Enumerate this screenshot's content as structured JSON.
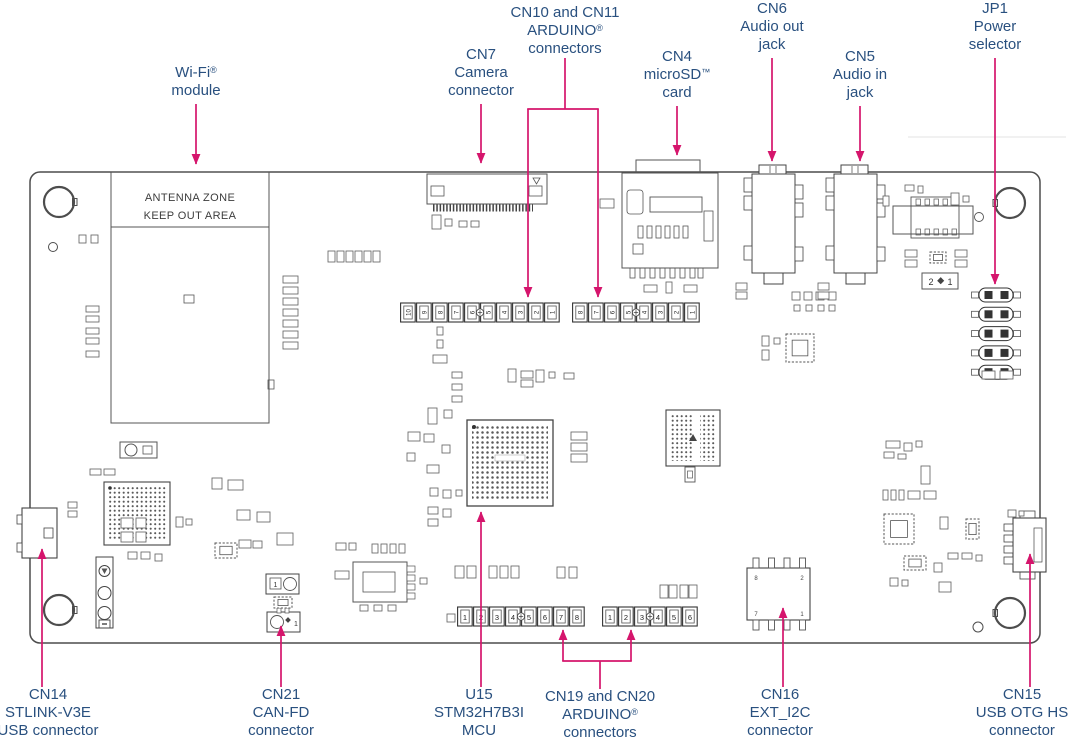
{
  "figure": {
    "type": "pcb-connector-diagram",
    "colors": {
      "label_text": "#29507f",
      "arrow": "#d5156c",
      "board_line": "#4d4d4d"
    },
    "board": {
      "antenna_zone_line1": "ANTENNA ZONE",
      "antenna_zone_line2": "KEEP OUT AREA",
      "power_jumper_box": [
        "2",
        "1"
      ],
      "can_jumper_pins": [
        "1",
        "1"
      ],
      "cn16_corner_pins": [
        "8",
        "2",
        "7",
        "1"
      ],
      "pin_labels": {
        "cn10": [
          "10",
          "9",
          "8",
          "7",
          "6",
          "5",
          "4",
          "3",
          "2",
          "1"
        ],
        "cn11": [
          "8",
          "7",
          "6",
          "5",
          "4",
          "3",
          "2",
          "1"
        ],
        "cn19": [
          "1",
          "2",
          "3",
          "4",
          "5",
          "6",
          "7",
          "8"
        ],
        "cn20": [
          "1",
          "2",
          "3",
          "4",
          "5",
          "6"
        ]
      }
    },
    "callouts": [
      {
        "id": "wifi-module",
        "position": "top",
        "lines": [
          "Wi-Fi®",
          "module"
        ]
      },
      {
        "id": "cn7-camera",
        "position": "top",
        "lines": [
          "CN7",
          "Camera",
          "connector"
        ]
      },
      {
        "id": "cn10-cn11-arduino",
        "position": "top",
        "lines": [
          "CN10 and CN11",
          "ARDUINO®",
          "connectors"
        ]
      },
      {
        "id": "cn4-microsd",
        "position": "top",
        "lines": [
          "CN4",
          "microSD™",
          "card"
        ]
      },
      {
        "id": "cn6-audio-out",
        "position": "top",
        "lines": [
          "CN6",
          "Audio out",
          "jack"
        ]
      },
      {
        "id": "cn5-audio-in",
        "position": "top",
        "lines": [
          "CN5",
          "Audio in",
          "jack"
        ]
      },
      {
        "id": "jp1-power-selector",
        "position": "top",
        "lines": [
          "JP1",
          "Power",
          "selector"
        ]
      },
      {
        "id": "cn14-stlink",
        "position": "bottom",
        "lines": [
          "CN14",
          "STLINK-V3E",
          "USB connector"
        ]
      },
      {
        "id": "cn21-canfd",
        "position": "bottom",
        "lines": [
          "CN21",
          "CAN-FD",
          "connector"
        ]
      },
      {
        "id": "u15-mcu",
        "position": "bottom",
        "lines": [
          "U15",
          "STM32H7B3I",
          "MCU"
        ]
      },
      {
        "id": "cn19-cn20-arduino",
        "position": "bottom",
        "lines": [
          "CN19 and CN20",
          "ARDUINO®",
          "connectors"
        ]
      },
      {
        "id": "cn16-ext-i2c",
        "position": "bottom",
        "lines": [
          "CN16",
          "EXT_I2C",
          "connector"
        ]
      },
      {
        "id": "cn15-usb-otg",
        "position": "bottom",
        "lines": [
          "CN15",
          "USB OTG HS",
          "connector"
        ]
      }
    ]
  }
}
